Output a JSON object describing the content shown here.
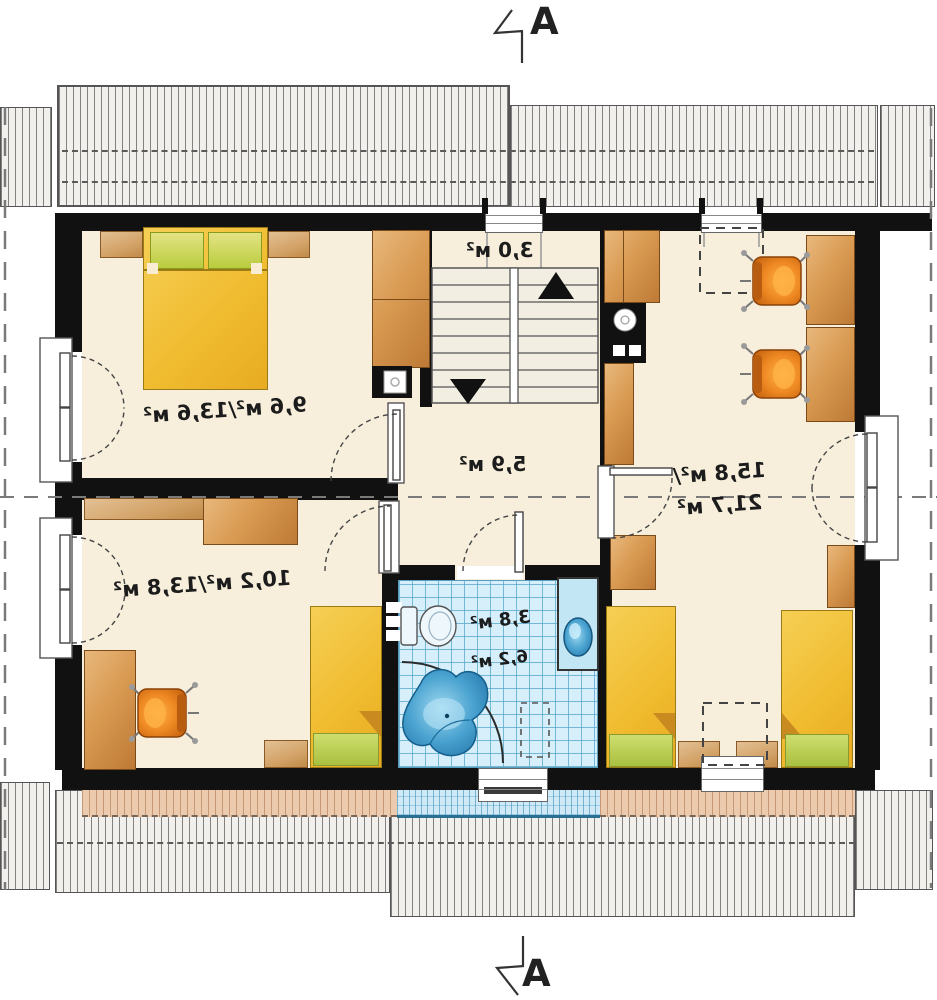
{
  "section_markers": {
    "top_label": "A",
    "bottom_label": "A"
  },
  "labels": {
    "staircase_area": "3,0 м²",
    "bedroom_top_left_area": "9,6 м²/13,6 м²",
    "hall_area": "5,9 м²",
    "room_right_area_line1": "15,8 м²/",
    "room_right_area_line2": "21,7 м²",
    "bedroom_bottom_left_area": "10,2 м²/13,8 м²",
    "bathroom_area_small": "3,8 м²",
    "bathroom_area_total": "6,2 м²"
  },
  "colors": {
    "floor": "#f7efdc",
    "wall": "#111111",
    "wood_light": "#e2b07a",
    "wood_dark": "#c07c38",
    "bed_yellow": "#f2c33e",
    "pillow_green": "#ccd65e",
    "chair_orange": "#ee8822",
    "tile_blue": "#d6effa",
    "tub_blue": "#2e8fc0",
    "hatch_bg": "#f2f0ec",
    "terrace_salmon": "#eccaae",
    "balcony_blue": "#cfeaf6"
  }
}
